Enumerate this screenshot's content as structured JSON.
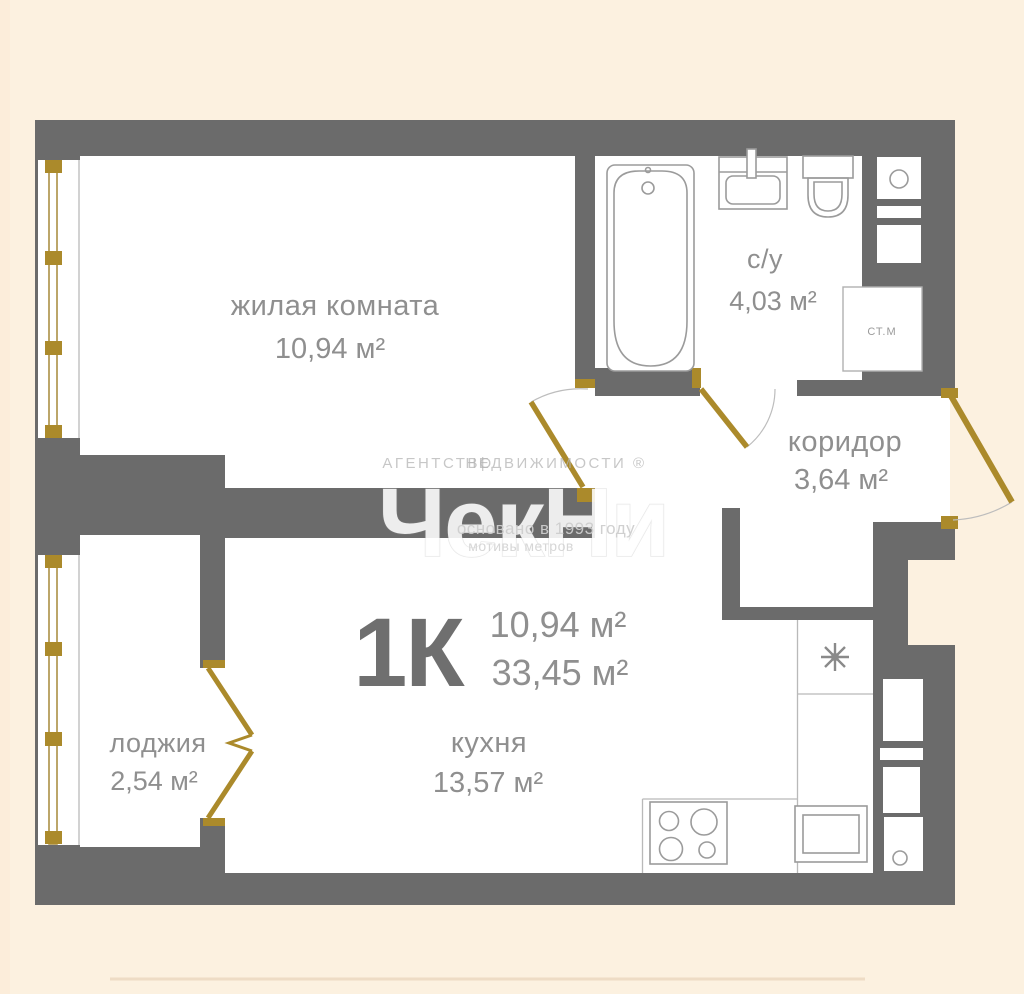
{
  "rooms": {
    "living": {
      "name": "жилая комната",
      "area": "10,94 м²"
    },
    "bathroom": {
      "name": "с/у",
      "area": "4,03 м²"
    },
    "corridor": {
      "name": "коридор",
      "area": "3,64 м²"
    },
    "kitchen": {
      "name": "кухня",
      "area": "13,57 м²"
    },
    "loggia": {
      "name": "лоджия",
      "area": "2,54 м²"
    }
  },
  "summary": {
    "type": "1К",
    "living_area": "10,94 м²",
    "total_area": "33,45 м²"
  },
  "fixtures": {
    "washing_machine": "СТ.М"
  },
  "watermark": {
    "agency": "АГЕНТСТВО",
    "divider": "|",
    "realty": "НЕДВИЖИМОСТИ ®",
    "logo": "ЧекНи",
    "founded": "основано в 1993 году",
    "slogan": "мотивы метров"
  },
  "colors": {
    "bg": "#fcf1e0",
    "wall": "#6b6b6b",
    "floor": "#ffffff",
    "gold": "#ab8a2b",
    "glaze": "#ac9045",
    "label": "#8f8f8f",
    "label-dark": "#6f6f6f",
    "fixture": "#9b9b9b"
  }
}
